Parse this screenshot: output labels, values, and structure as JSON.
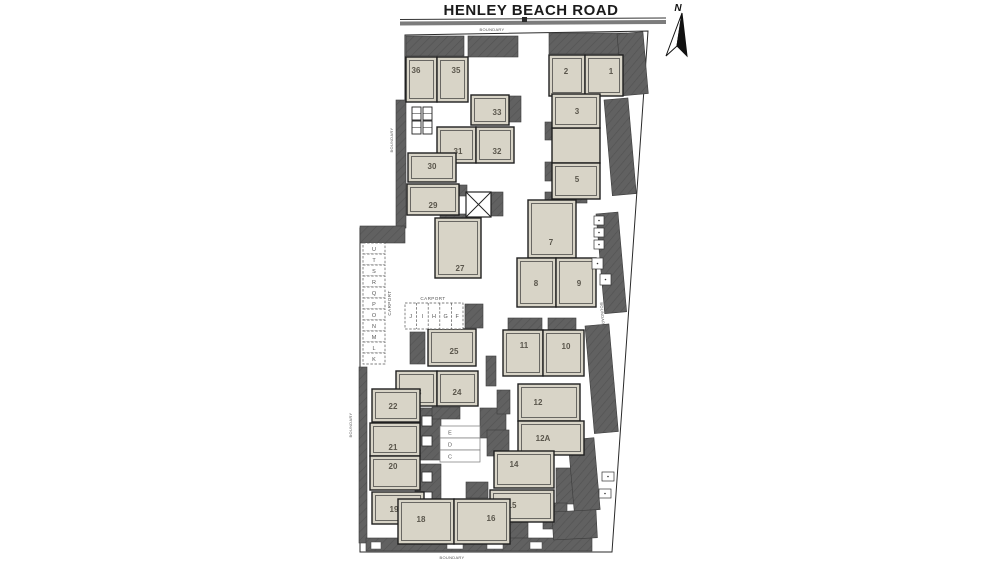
{
  "title": "HENLEY BEACH ROAD",
  "north": "N",
  "labels": {
    "boundary": "BOUNDARY",
    "carport": "CARPORT"
  },
  "colors": {
    "building_fill": "#d8d4c7",
    "building_stroke": "#1f1f1f",
    "paving_fill": "#616161",
    "paving_hatch": "#535353",
    "unit_label": "#5a564c",
    "road_gray": "#7c7c7c"
  },
  "units": [
    {
      "label": "36",
      "x": 406,
      "y": 57,
      "w": 31,
      "h": 45,
      "tx": 416,
      "ty": 73
    },
    {
      "label": "35",
      "x": 437,
      "y": 57,
      "w": 31,
      "h": 45,
      "tx": 456,
      "ty": 73
    },
    {
      "label": "2",
      "x": 549,
      "y": 55,
      "w": 36,
      "h": 41,
      "tx": 566,
      "ty": 74
    },
    {
      "label": "1",
      "x": 585,
      "y": 55,
      "w": 38,
      "h": 41,
      "tx": 611,
      "ty": 74
    },
    {
      "label": "33",
      "x": 471,
      "y": 95,
      "w": 38,
      "h": 30,
      "tx": 497,
      "ty": 115
    },
    {
      "label": "3",
      "x": 552,
      "y": 94,
      "w": 48,
      "h": 34,
      "tx": 577,
      "ty": 114
    },
    {
      "label": "5",
      "x": 552,
      "y": 163,
      "w": 48,
      "h": 36,
      "tx": 577,
      "ty": 182
    },
    {
      "label": "31",
      "x": 437,
      "y": 127,
      "w": 39,
      "h": 36,
      "tx": 458,
      "ty": 154
    },
    {
      "label": "32",
      "x": 476,
      "y": 127,
      "w": 38,
      "h": 36,
      "tx": 497,
      "ty": 154
    },
    {
      "label": "30",
      "x": 408,
      "y": 153,
      "w": 48,
      "h": 29,
      "tx": 432,
      "ty": 169
    },
    {
      "label": "29",
      "x": 407,
      "y": 184,
      "w": 52,
      "h": 31,
      "tx": 433,
      "ty": 208
    },
    {
      "label": "27",
      "x": 435,
      "y": 218,
      "w": 46,
      "h": 60,
      "tx": 460,
      "ty": 271
    },
    {
      "label": "7",
      "x": 528,
      "y": 200,
      "w": 48,
      "h": 58,
      "tx": 551,
      "ty": 245
    },
    {
      "label": "8",
      "x": 517,
      "y": 258,
      "w": 39,
      "h": 49,
      "tx": 536,
      "ty": 286
    },
    {
      "label": "9",
      "x": 556,
      "y": 258,
      "w": 40,
      "h": 49,
      "tx": 579,
      "ty": 286
    },
    {
      "label": "25",
      "x": 428,
      "y": 329,
      "w": 48,
      "h": 37,
      "tx": 454,
      "ty": 354
    },
    {
      "label": "11",
      "x": 503,
      "y": 330,
      "w": 40,
      "h": 46,
      "tx": 524,
      "ty": 348
    },
    {
      "label": "10",
      "x": 543,
      "y": 330,
      "w": 41,
      "h": 46,
      "tx": 566,
      "ty": 349
    },
    {
      "label": "12",
      "x": 518,
      "y": 384,
      "w": 62,
      "h": 37,
      "tx": 538,
      "ty": 405
    },
    {
      "label": "12A",
      "x": 518,
      "y": 421,
      "w": 66,
      "h": 34,
      "tx": 543,
      "ty": 441
    },
    {
      "label": "23",
      "x": 396,
      "y": 371,
      "w": 41,
      "h": 35,
      "tx": 417,
      "ty": 395
    },
    {
      "label": "24",
      "x": 437,
      "y": 371,
      "w": 41,
      "h": 35,
      "tx": 457,
      "ty": 395
    },
    {
      "label": "22",
      "x": 372,
      "y": 389,
      "w": 48,
      "h": 33,
      "tx": 393,
      "ty": 409
    },
    {
      "label": "21",
      "x": 370,
      "y": 423,
      "w": 50,
      "h": 33,
      "tx": 393,
      "ty": 450
    },
    {
      "label": "20",
      "x": 370,
      "y": 456,
      "w": 50,
      "h": 34,
      "tx": 393,
      "ty": 469
    },
    {
      "label": "19",
      "x": 372,
      "y": 492,
      "w": 52,
      "h": 32,
      "tx": 394,
      "ty": 512
    },
    {
      "label": "14",
      "x": 494,
      "y": 451,
      "w": 60,
      "h": 37,
      "tx": 514,
      "ty": 467
    },
    {
      "label": "15",
      "x": 490,
      "y": 490,
      "w": 64,
      "h": 32,
      "tx": 512,
      "ty": 508
    },
    {
      "label": "18",
      "x": 398,
      "y": 499,
      "w": 56,
      "h": 45,
      "tx": 421,
      "ty": 522
    },
    {
      "label": "16",
      "x": 454,
      "y": 499,
      "w": 56,
      "h": 45,
      "tx": 491,
      "ty": 521
    }
  ],
  "extra_buildings": [
    {
      "x": 552,
      "y": 128,
      "w": 48,
      "h": 35
    }
  ],
  "dark_blocks": [
    [
      406,
      36,
      58,
      20
    ],
    [
      468,
      36,
      50,
      21
    ],
    [
      549,
      33,
      78,
      21
    ],
    [
      622,
      68,
      20,
      17
    ],
    [
      506,
      96,
      15,
      26
    ],
    [
      438,
      127,
      13,
      35
    ],
    [
      396,
      100,
      10,
      128
    ],
    [
      360,
      226,
      45,
      17
    ],
    [
      449,
      185,
      18,
      11
    ],
    [
      491,
      192,
      12,
      24
    ],
    [
      440,
      214,
      28,
      12
    ],
    [
      545,
      122,
      13,
      18
    ],
    [
      545,
      162,
      13,
      19
    ],
    [
      545,
      192,
      42,
      11
    ],
    [
      410,
      332,
      15,
      32
    ],
    [
      465,
      304,
      18,
      24
    ],
    [
      359,
      367,
      8,
      176
    ],
    [
      415,
      408,
      26,
      52
    ],
    [
      415,
      464,
      26,
      56
    ],
    [
      432,
      407,
      28,
      12
    ],
    [
      480,
      408,
      26,
      30
    ],
    [
      508,
      318,
      34,
      13
    ],
    [
      548,
      318,
      28,
      12
    ],
    [
      486,
      356,
      10,
      30
    ],
    [
      497,
      390,
      13,
      24
    ],
    [
      487,
      430,
      22,
      26
    ],
    [
      556,
      468,
      20,
      36
    ],
    [
      466,
      482,
      22,
      16
    ],
    [
      500,
      522,
      28,
      20
    ],
    [
      543,
      503,
      24,
      26
    ],
    [
      366,
      538,
      226,
      13
    ],
    [
      617,
      34,
      26,
      62,
      -5
    ],
    [
      604,
      100,
      24,
      96,
      -5
    ],
    [
      596,
      214,
      22,
      100,
      -5
    ],
    [
      585,
      326,
      24,
      108,
      -5
    ],
    [
      568,
      440,
      26,
      72,
      -5
    ],
    [
      552,
      512,
      44,
      28,
      -3
    ]
  ],
  "white_marks": [
    [
      447,
      542,
      16,
      7
    ],
    [
      487,
      542,
      16,
      7
    ],
    [
      530,
      542,
      12,
      7
    ],
    [
      371,
      542,
      10,
      7
    ]
  ],
  "bin_boxes": [
    [
      412,
      107,
      9,
      13
    ],
    [
      423,
      107,
      9,
      13
    ],
    [
      412,
      121,
      9,
      13
    ],
    [
      423,
      121,
      9,
      13
    ]
  ],
  "small_boxes": [
    [
      594,
      216,
      10,
      9
    ],
    [
      594,
      228,
      10,
      9
    ],
    [
      594,
      240,
      10,
      9
    ],
    [
      592,
      258,
      11,
      11
    ],
    [
      600,
      274,
      11,
      11
    ],
    [
      599,
      489,
      12,
      9
    ],
    [
      602,
      472,
      12,
      9
    ]
  ],
  "garage_squares": [
    [
      422,
      416,
      10,
      10
    ],
    [
      422,
      436,
      10,
      10
    ],
    [
      422,
      472,
      10,
      10
    ],
    [
      422,
      492,
      10,
      10
    ]
  ],
  "crossed_box": {
    "x": 466,
    "y": 192,
    "w": 25,
    "h": 25
  },
  "carport_left": {
    "bays": [
      "U",
      "T",
      "S",
      "R",
      "Q",
      "P",
      "O",
      "N",
      "M",
      "L",
      "K"
    ],
    "x": 363,
    "y": 243,
    "w": 22,
    "bay_h": 11
  },
  "carport_top": {
    "bays": [
      "J",
      "I",
      "H",
      "G",
      "F"
    ],
    "x": 405,
    "y": 303,
    "w": 58,
    "h": 26
  },
  "carport_mid": {
    "bays": [
      "E",
      "D",
      "C"
    ],
    "x": 440,
    "y": 426,
    "w": 40,
    "bay_h": 12
  }
}
